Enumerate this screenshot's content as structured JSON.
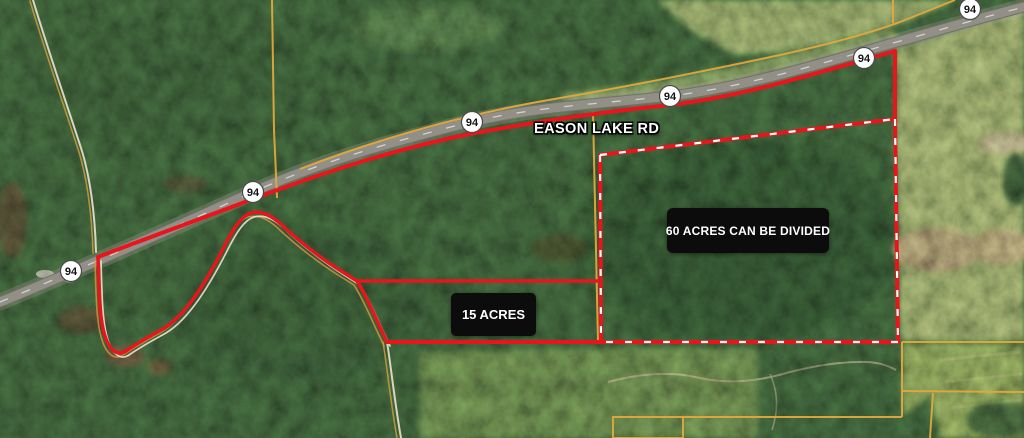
{
  "map": {
    "type": "satellite-parcel-map",
    "road_label": "EASON LAKE RD",
    "highway_shields": [
      {
        "route": "94"
      },
      {
        "route": "94"
      },
      {
        "route": "94"
      },
      {
        "route": "94"
      },
      {
        "route": "94"
      },
      {
        "route": "94"
      }
    ],
    "parcel_annotations": [
      {
        "id": "60-acres",
        "label": "60 ACRES CAN BE DIVIDED",
        "boundary_style": "dashed-red"
      },
      {
        "id": "15-acres",
        "label": "15 ACRES",
        "boundary_style": "solid-red"
      }
    ],
    "colors": {
      "boundary_red": "#e9151d",
      "boundary_dash_white": "#ffffff",
      "parcel_line_yellow": "#e2a83d",
      "creek_white": "#e9e3cf",
      "creek_orange": "#cf9a3e",
      "road_gray": "#918f86",
      "label_bg": "#0c0c0c",
      "label_text": "#ffffff",
      "shield_bg": "#ffffff",
      "shield_text": "#141414"
    }
  }
}
